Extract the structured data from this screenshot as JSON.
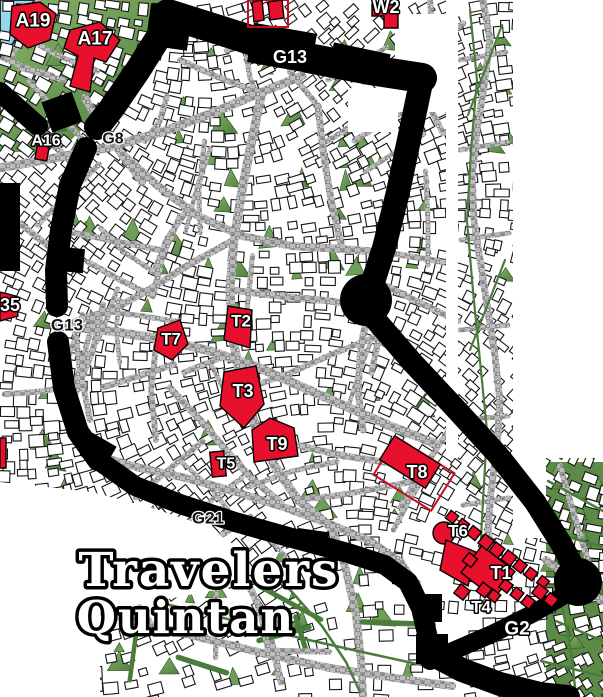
{
  "title": {
    "line1": "Travelers",
    "line2": "Quintan"
  },
  "labels": [
    {
      "id": "A19",
      "text": "A19",
      "x": 33,
      "y": 21,
      "size": 19,
      "variant": "light"
    },
    {
      "id": "A17",
      "text": "A17",
      "x": 95,
      "y": 39,
      "size": 19,
      "variant": "light"
    },
    {
      "id": "A16",
      "text": "A16",
      "x": 46,
      "y": 141,
      "size": 16,
      "variant": "light"
    },
    {
      "id": "G8",
      "text": "G8",
      "x": 113,
      "y": 139,
      "size": 16,
      "variant": "dark"
    },
    {
      "id": "G13-north",
      "text": "G13",
      "x": 290,
      "y": 57,
      "size": 18,
      "variant": "light"
    },
    {
      "id": "W2",
      "text": "W2",
      "x": 386,
      "y": 7,
      "size": 18,
      "variant": "light"
    },
    {
      "id": "A35",
      "text": "35",
      "x": 10,
      "y": 305,
      "size": 18,
      "variant": "light"
    },
    {
      "id": "G13-west",
      "text": "G13",
      "x": 67,
      "y": 325,
      "size": 17,
      "variant": "dark"
    },
    {
      "id": "T7",
      "text": "T7",
      "x": 171,
      "y": 339,
      "size": 17,
      "variant": "light"
    },
    {
      "id": "T2",
      "text": "T2",
      "x": 241,
      "y": 321,
      "size": 17,
      "variant": "light"
    },
    {
      "id": "T3",
      "text": "T3",
      "x": 243,
      "y": 391,
      "size": 18,
      "variant": "light"
    },
    {
      "id": "T9",
      "text": "T9",
      "x": 277,
      "y": 444,
      "size": 18,
      "variant": "light"
    },
    {
      "id": "T5",
      "text": "T5",
      "x": 226,
      "y": 464,
      "size": 16,
      "variant": "light"
    },
    {
      "id": "T8",
      "text": "T8",
      "x": 417,
      "y": 472,
      "size": 18,
      "variant": "light"
    },
    {
      "id": "G21",
      "text": "G21",
      "x": 208,
      "y": 518,
      "size": 17,
      "variant": "dark"
    },
    {
      "id": "T6",
      "text": "T6",
      "x": 458,
      "y": 531,
      "size": 17,
      "variant": "light"
    },
    {
      "id": "T1",
      "text": "T1",
      "x": 501,
      "y": 573,
      "size": 18,
      "variant": "light"
    },
    {
      "id": "T4",
      "text": "T4",
      "x": 481,
      "y": 607,
      "size": 17,
      "variant": "light"
    },
    {
      "id": "G2",
      "text": "G2",
      "x": 517,
      "y": 629,
      "size": 19,
      "variant": "light"
    }
  ],
  "colors": {
    "building_red": "#e8112d",
    "red_outline": "#c70d22",
    "wall_black": "#000000",
    "water_blue": "#97d6ec",
    "park_green_light": "#86b36a",
    "park_green_dark": "#4e7e3d",
    "hedge_green": "#4a7d3c",
    "street_gray": "#a6a6a6",
    "building_white": "#ffffff",
    "label_light": "#ffffff",
    "label_dark": "#141414"
  }
}
